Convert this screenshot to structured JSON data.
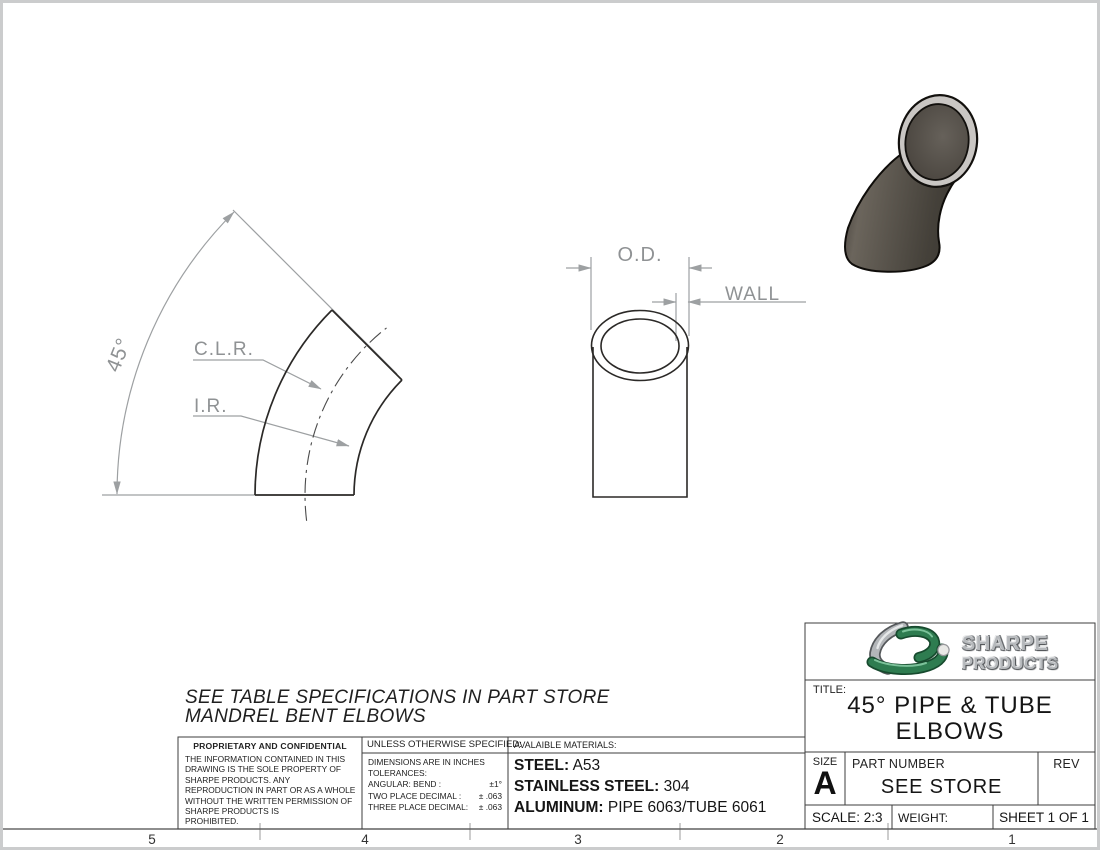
{
  "page": {
    "zones": [
      "5",
      "4",
      "3",
      "2",
      "1"
    ]
  },
  "dimension_labels": {
    "angle": "45°",
    "clr": "C.L.R.",
    "ir": "I.R.",
    "od": "O.D.",
    "wall": "WALL"
  },
  "note": {
    "line1": "SEE TABLE SPECIFICATIONS IN PART STORE",
    "line2": "MANDREL BENT ELBOWS"
  },
  "proprietary": {
    "heading": "PROPRIETARY AND CONFIDENTIAL",
    "body": "THE INFORMATION CONTAINED IN THIS\nDRAWING IS THE SOLE PROPERTY OF\nSHARPE PRODUCTS.  ANY\nREPRODUCTION IN PART OR AS A WHOLE\nWITHOUT THE WRITTEN PERMISSION OF\nSHARPE PRODUCTS IS\nPROHIBITED."
  },
  "tolerances": {
    "heading": "UNLESS OTHERWISE SPECIFIED:",
    "dims": "DIMENSIONS ARE IN INCHES",
    "tol": "TOLERANCES:",
    "rows": [
      {
        "label": "ANGULAR: BEND :",
        "value": "±1°"
      },
      {
        "label": "TWO PLACE DECIMAL :",
        "value": "± .063"
      },
      {
        "label": "THREE PLACE DECIMAL:",
        "value": "± .063"
      }
    ]
  },
  "materials": {
    "heading": "AVALAIBLE MATERIALS:",
    "items": [
      {
        "label": "STEEL:",
        "value": "A53"
      },
      {
        "label": "STAINLESS STEEL:",
        "value": "304"
      },
      {
        "label": "ALUMINUM:",
        "value": "PIPE 6063/TUBE 6061"
      }
    ]
  },
  "title_block": {
    "brand_top": "SHARPE",
    "brand_bottom": "PRODUCTS",
    "title_label": "TITLE:",
    "title_line1": "45° PIPE & TUBE",
    "title_line2": "ELBOWS",
    "size_label": "SIZE",
    "size_value": "A",
    "part_number_label": "PART NUMBER",
    "part_number_value": "SEE STORE",
    "rev_label": "REV",
    "scale": "SCALE: 2:3",
    "weight_label": "WEIGHT:",
    "sheet_label": "SHEET 1 OF 1"
  },
  "colors": {
    "brand_green": "#2e7c50",
    "drawing_line": "#2b2927",
    "dimension_gray": "#8f9294",
    "metal_gray": "#b6b9bc",
    "elbow_body": "#534e47",
    "elbow_rim": "#c9c6c3"
  }
}
